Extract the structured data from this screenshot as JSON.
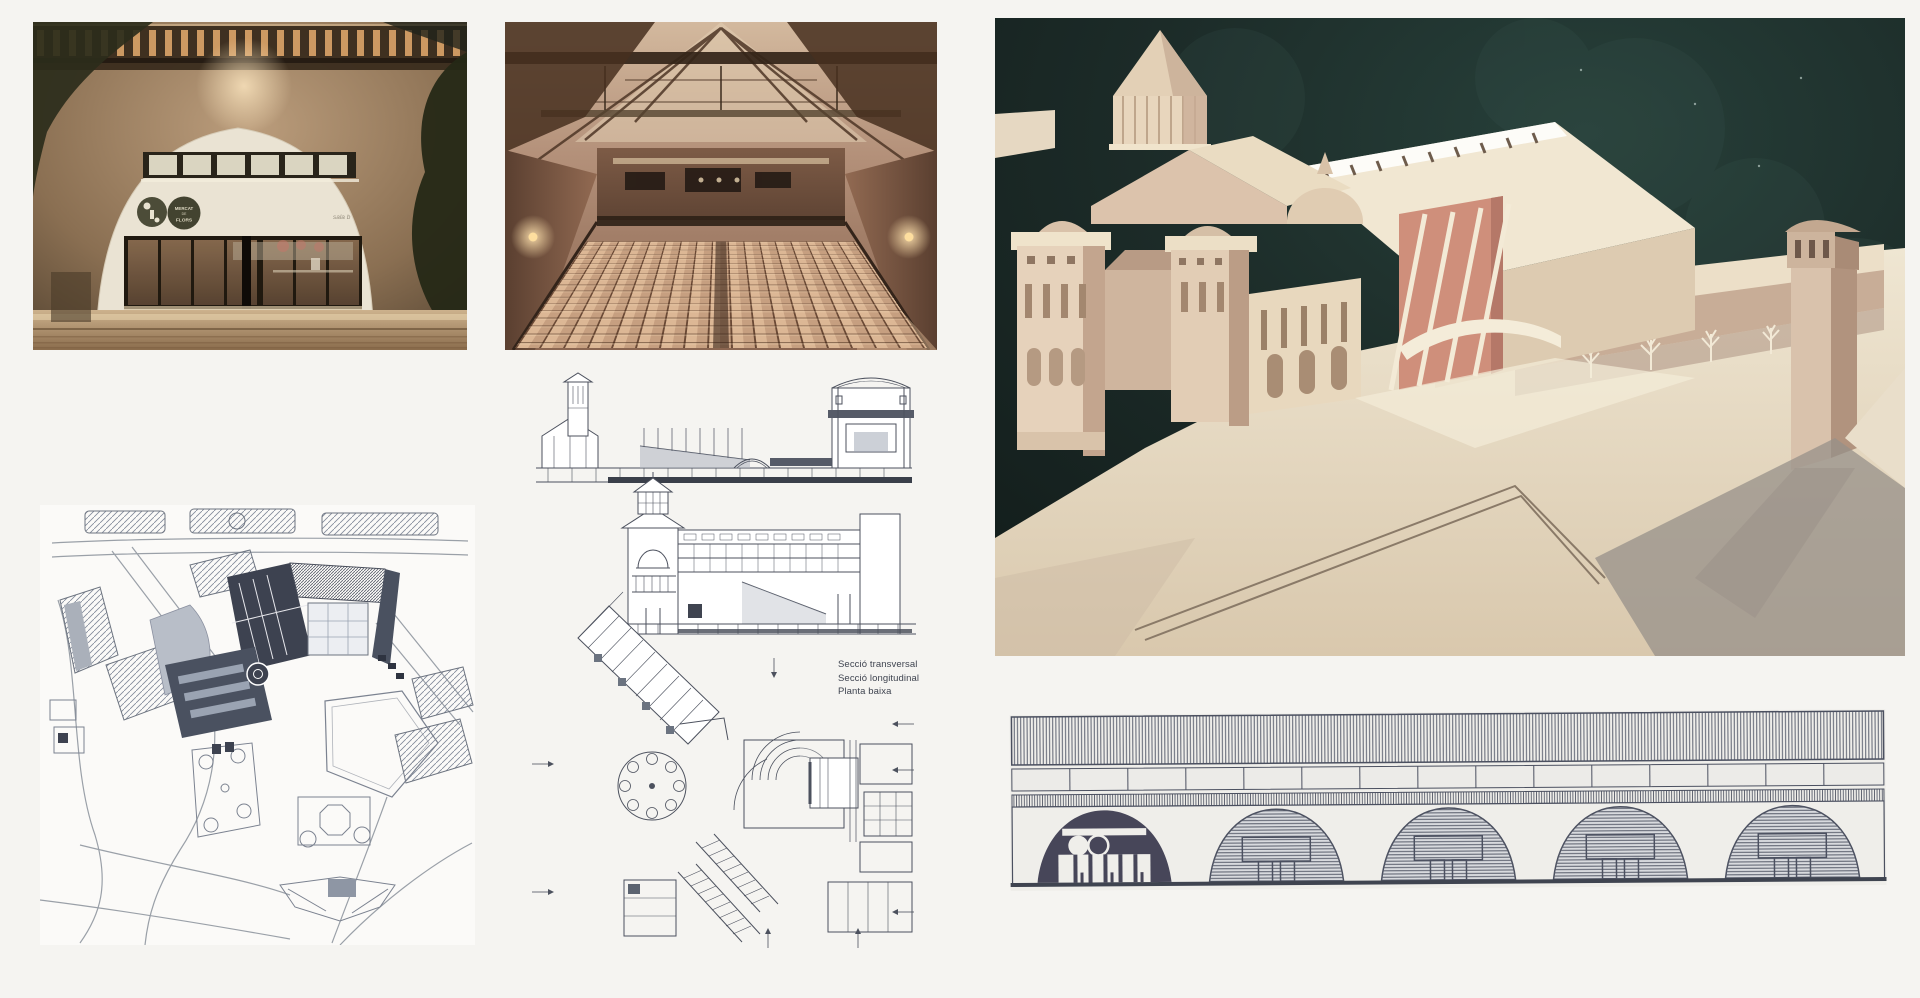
{
  "page": {
    "background": "#f5f4f1"
  },
  "entrance_photo": {
    "logo": {
      "line1": "MERCAT",
      "line2": "DE",
      "line3": "FLORS"
    },
    "side_label": "sala b",
    "colors": {
      "stone_wall": "#8d7257",
      "foliage": "#272a18",
      "arch_wall": "#eae3d3",
      "door_frame": "#20190f",
      "warm_light": "#d59a60"
    }
  },
  "auditorium_photo": {
    "colors": {
      "roof_beams": "#332418",
      "walls": "#8a6550",
      "seats": "#dcb795",
      "sconce_glow": "#ffe2ae"
    }
  },
  "model_photo": {
    "colors": {
      "sky": "#1c2b28",
      "model_card": "#f0e6d0",
      "shadow_side": "#c9ae99",
      "accent_pink": "#cf8f7b",
      "ground": "#e9ddc6"
    }
  },
  "site_plan": {
    "colors": {
      "paper": "#fbfaf8",
      "ink": "#7b8290",
      "dark_building": "#3d4250",
      "gray_block": "#aab0ba"
    }
  },
  "drawings": {
    "labels": {
      "transversal": "Secció transversal",
      "longitudinal": "Secció longitudinal",
      "ground": "Planta baixa"
    },
    "colors": {
      "paper": "#fcfbf9",
      "ink": "#4c515e"
    }
  },
  "elevation": {
    "colors": {
      "paper": "#efeeea",
      "ink": "#4b5060",
      "dark_arch": "#474659"
    }
  }
}
